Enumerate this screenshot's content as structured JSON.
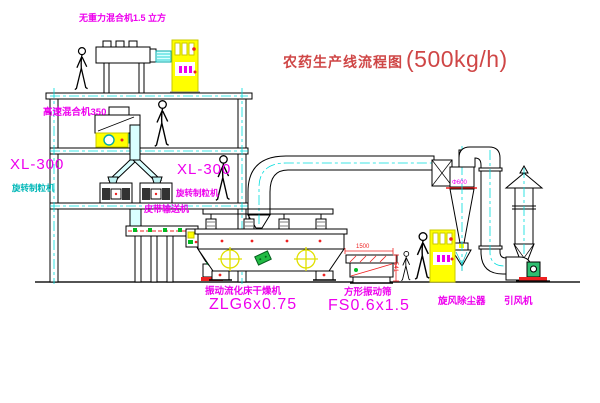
{
  "title": {
    "text": "农药生产线流程图",
    "capacity": "(500kg/h)"
  },
  "equipment": {
    "gravity_mixer": {
      "label": "无重力混合机1.5 立方"
    },
    "high_speed_mixer": {
      "label": "高速混合机350"
    },
    "granulator_left": {
      "model": "XL-300",
      "label": "旋转制粒机"
    },
    "granulator_right": {
      "model": "XL-300",
      "label": "旋转制粒机"
    },
    "belt_conveyor": {
      "label": "皮带输送机"
    },
    "fluid_bed_dryer": {
      "label": "振动流化床干燥机",
      "model": "ZLG6x0.75"
    },
    "vibrating_screen": {
      "label": "方形振动筛",
      "model": "FS0.6x1.5",
      "dim_width": "1500",
      "dim_height": "541"
    },
    "cyclone": {
      "label": "旋风除尘器",
      "diameter": "Φ600"
    },
    "fan": {
      "label": "引风机"
    }
  },
  "colors": {
    "label_magenta": "#ee00ee",
    "title_red": "#cf4646",
    "centerline_cyan": "#00dddd",
    "highlight_yellow": "#ffff00",
    "dimension_red": "#ee2222",
    "machine_green": "#22bb44"
  }
}
